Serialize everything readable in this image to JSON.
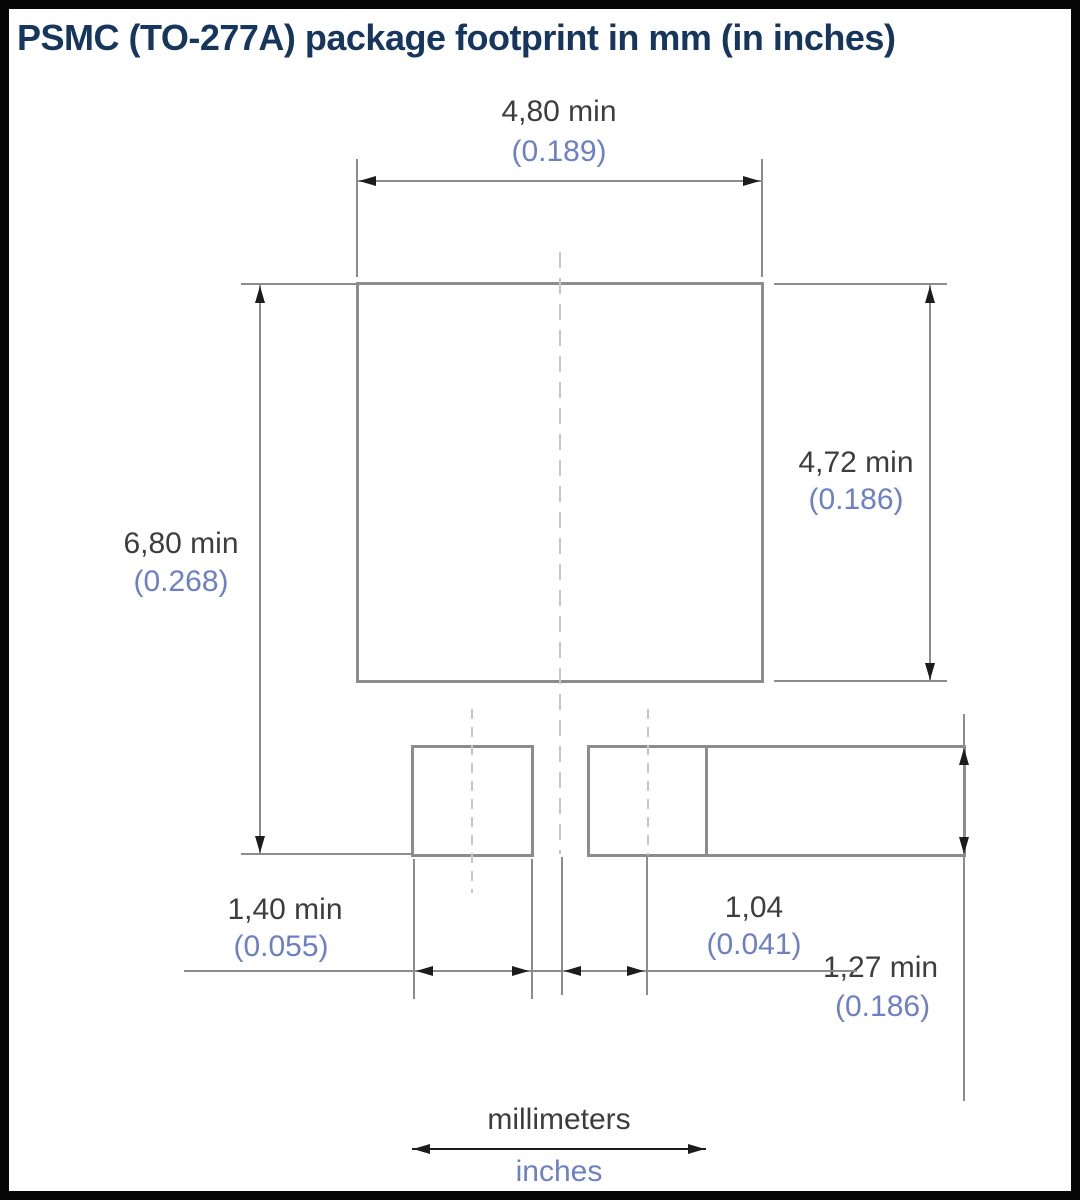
{
  "title": "PSMC (TO-277A) package footprint in mm (in inches)",
  "dimensions": {
    "top_width": {
      "mm": "4,80 min",
      "inches": "(0.189)"
    },
    "right_height": {
      "mm": "4,72 min",
      "inches": "(0.186)"
    },
    "overall_height": {
      "mm": "6,80 min",
      "inches": "(0.268)"
    },
    "small_pad_width": {
      "mm": "1,40 min",
      "inches": "(0.055)"
    },
    "center_offset": {
      "mm": "1,04",
      "inches": "(0.041)"
    },
    "pad_row_height": {
      "mm": "1,27 min",
      "inches": "(0.186)"
    }
  },
  "legend": {
    "millimeters": "millimeters",
    "inches": "inches"
  },
  "colors": {
    "title_text": "#17365d",
    "metric_text": "#3d3d3d",
    "inch_text": "#6d80c4",
    "line": "#8c8c8c",
    "cline": "#c6c6c6",
    "arrow": "#1c1c1c",
    "frame": "#060606"
  }
}
